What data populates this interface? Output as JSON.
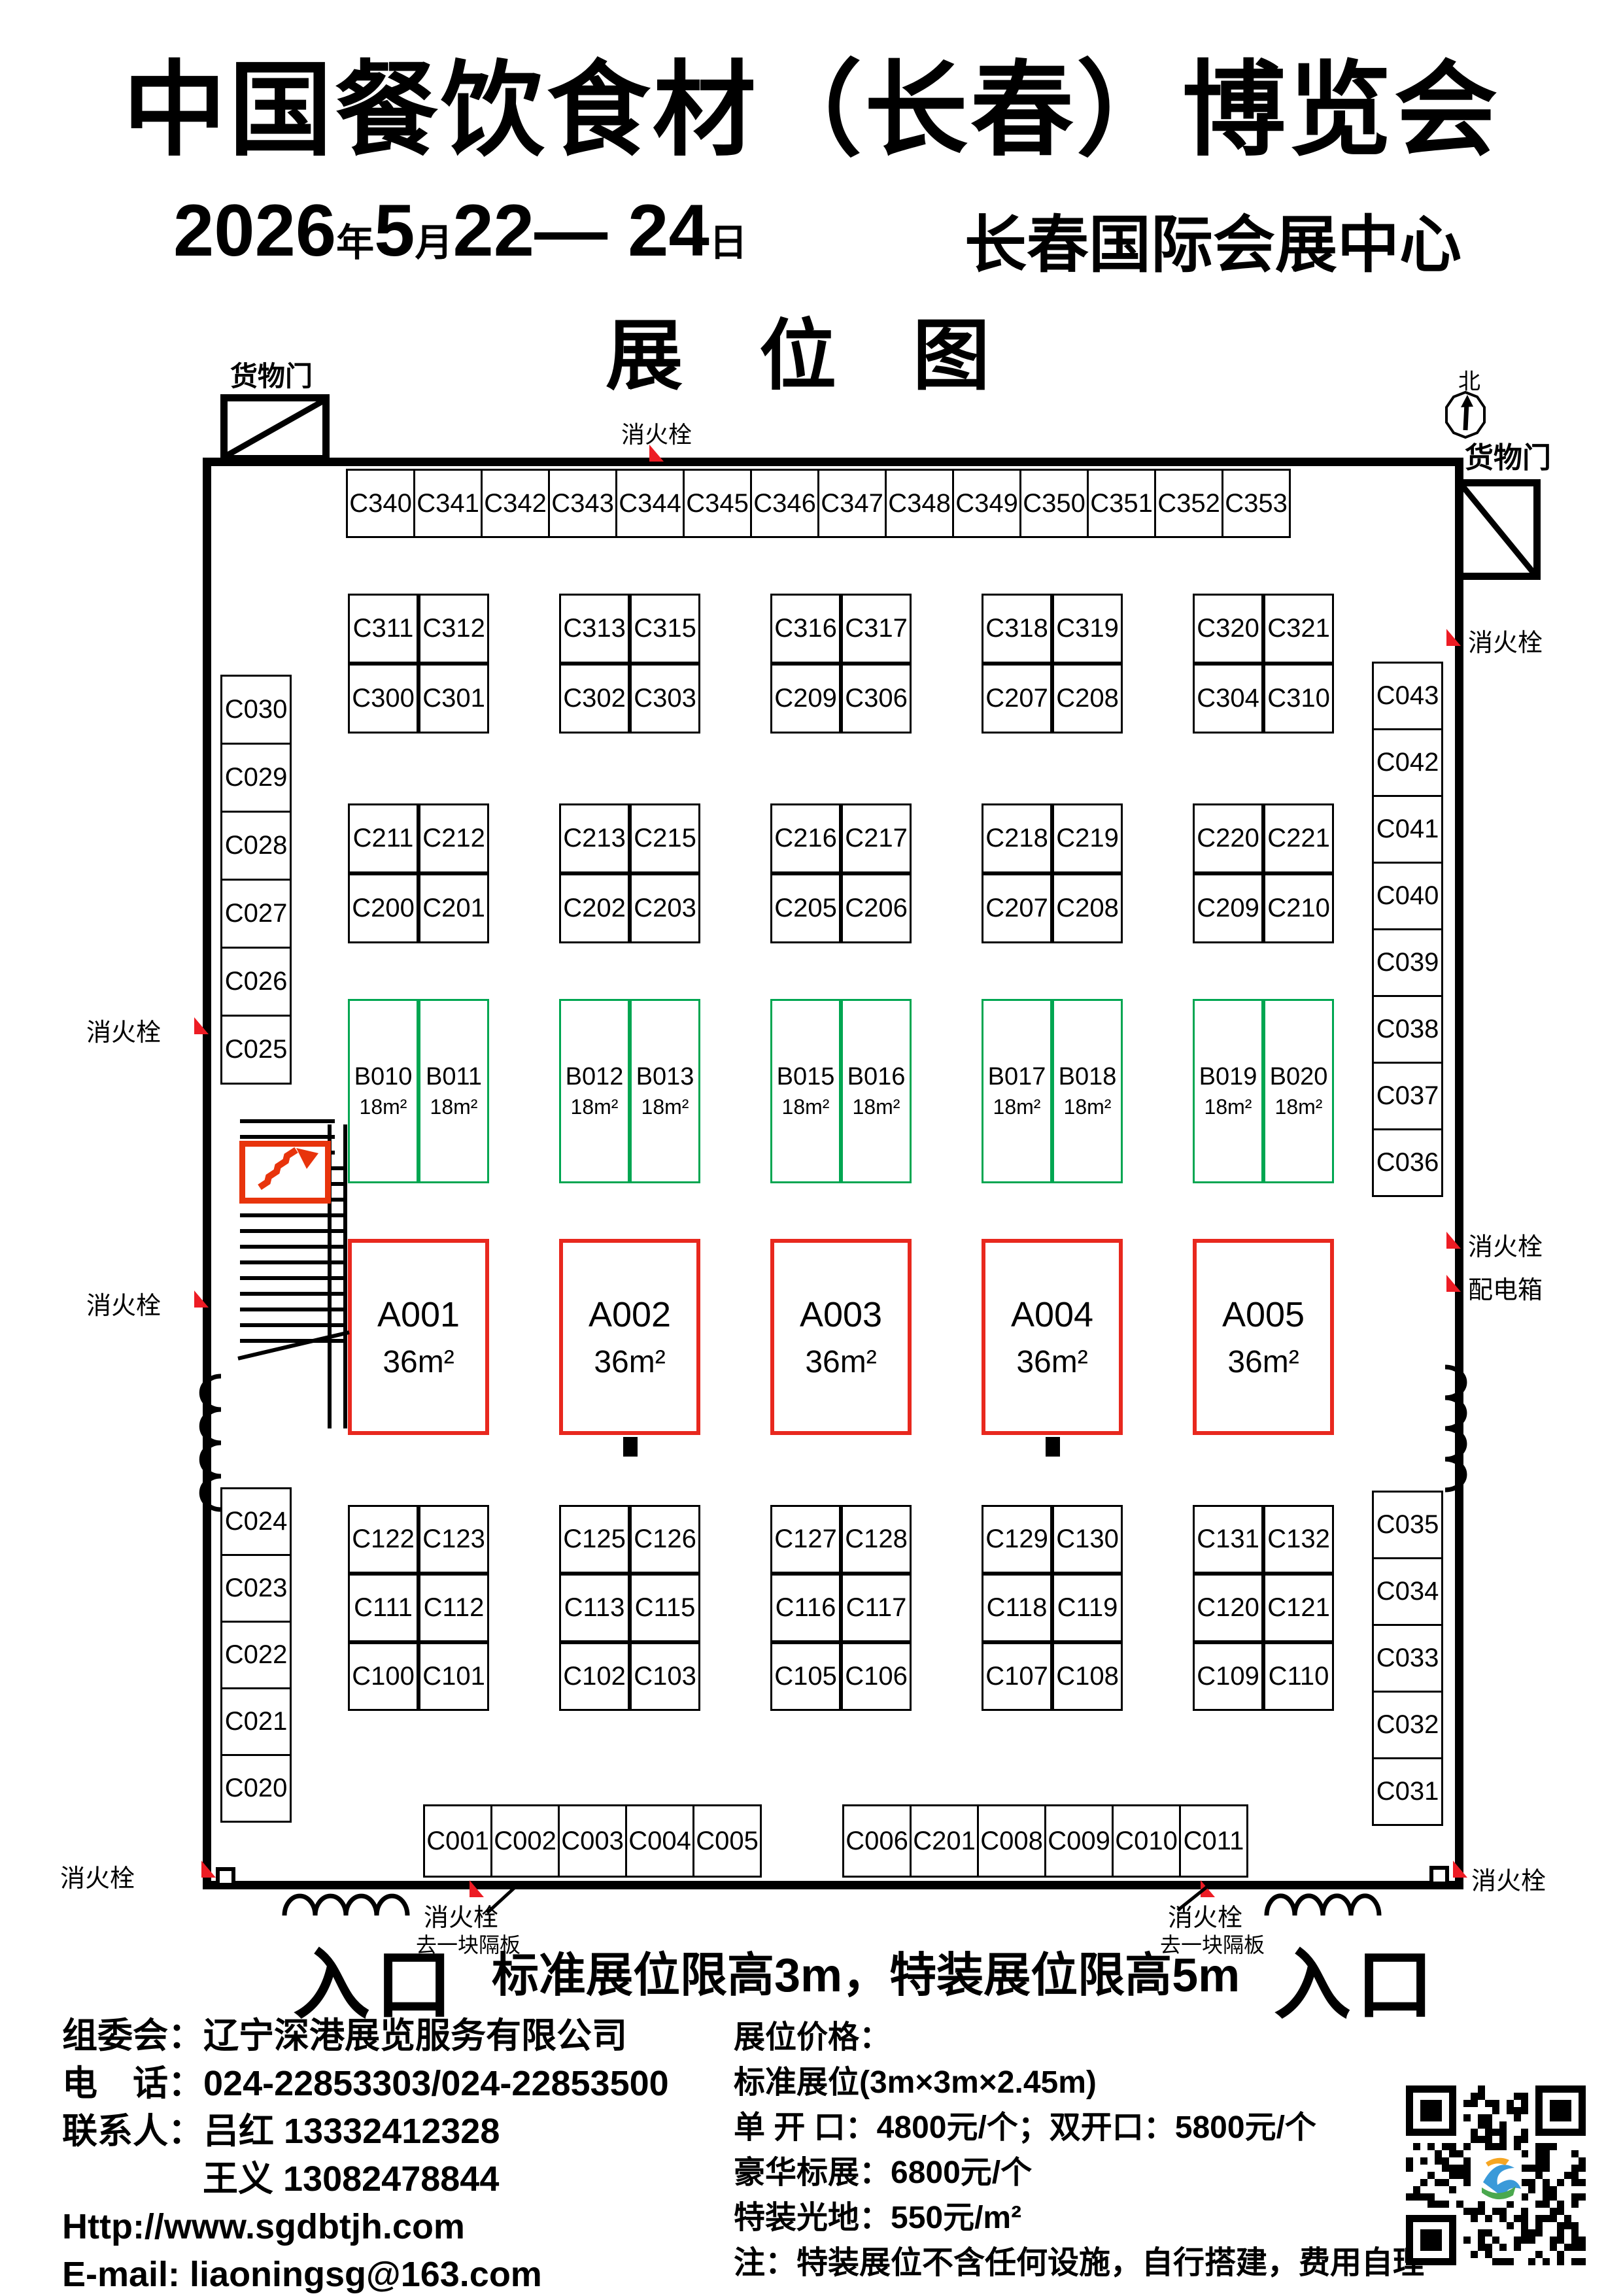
{
  "header": {
    "title": "中国餐饮食材（长春）博览会",
    "date": {
      "year": "2026",
      "year_suffix": "年",
      "month": "5",
      "month_suffix": "月",
      "days": "22— 24",
      "day_suffix": "日"
    },
    "venue": "长春国际会展中心",
    "map_title": "展 位 图"
  },
  "plan_labels": {
    "north": "北",
    "cargo_door": "货物门",
    "fire_hydrant": "消火栓",
    "power_box": "配电箱",
    "remove_panel": "去一块隔板",
    "entrance": "入口",
    "height_note": "标准展位限高3m，特装展位限高5m"
  },
  "booths": {
    "top_row": [
      "C340",
      "C341",
      "C342",
      "C343",
      "C344",
      "C345",
      "C346",
      "C347",
      "C348",
      "C349",
      "C350",
      "C351",
      "C352",
      "C353"
    ],
    "upper_blocks": [
      [
        "C311",
        "C312",
        "C300",
        "C301"
      ],
      [
        "C313",
        "C315",
        "C302",
        "C303"
      ],
      [
        "C316",
        "C317",
        "C209",
        "C306"
      ],
      [
        "C318",
        "C319",
        "C207",
        "C208"
      ],
      [
        "C320",
        "C321",
        "C304",
        "C310"
      ]
    ],
    "mid_blocks": [
      [
        "C211",
        "C212",
        "C200",
        "C201"
      ],
      [
        "C213",
        "C215",
        "C202",
        "C203"
      ],
      [
        "C216",
        "C217",
        "C205",
        "C206"
      ],
      [
        "C218",
        "C219",
        "C207",
        "C208"
      ],
      [
        "C220",
        "C221",
        "C209",
        "C210"
      ]
    ],
    "b_blocks": [
      [
        {
          "id": "B010",
          "area": "18m²"
        },
        {
          "id": "B011",
          "area": "18m²"
        }
      ],
      [
        {
          "id": "B012",
          "area": "18m²"
        },
        {
          "id": "B013",
          "area": "18m²"
        }
      ],
      [
        {
          "id": "B015",
          "area": "18m²"
        },
        {
          "id": "B016",
          "area": "18m²"
        }
      ],
      [
        {
          "id": "B017",
          "area": "18m²"
        },
        {
          "id": "B018",
          "area": "18m²"
        }
      ],
      [
        {
          "id": "B019",
          "area": "18m²"
        },
        {
          "id": "B020",
          "area": "18m²"
        }
      ]
    ],
    "a_row": [
      {
        "id": "A001",
        "area": "36m²"
      },
      {
        "id": "A002",
        "area": "36m²"
      },
      {
        "id": "A003",
        "area": "36m²"
      },
      {
        "id": "A004",
        "area": "36m²"
      },
      {
        "id": "A005",
        "area": "36m²"
      }
    ],
    "lower_blocks": [
      [
        "C122",
        "C123",
        "C111",
        "C112",
        "C100",
        "C101"
      ],
      [
        "C125",
        "C126",
        "C113",
        "C115",
        "C102",
        "C103"
      ],
      [
        "C127",
        "C128",
        "C116",
        "C117",
        "C105",
        "C106"
      ],
      [
        "C129",
        "C130",
        "C118",
        "C119",
        "C107",
        "C108"
      ],
      [
        "C131",
        "C132",
        "C120",
        "C121",
        "C109",
        "C110"
      ]
    ],
    "left_col_upper": [
      "C030",
      "C029",
      "C028",
      "C027",
      "C026",
      "C025"
    ],
    "left_col_lower": [
      "C024",
      "C023",
      "C022",
      "C021",
      "C020"
    ],
    "right_col_upper": [
      "C043",
      "C042",
      "C041",
      "C040",
      "C039",
      "C038",
      "C037",
      "C036"
    ],
    "right_col_lower": [
      "C035",
      "C034",
      "C033",
      "C032",
      "C031"
    ],
    "bottom_row_1": [
      "C001",
      "C002",
      "C003",
      "C004",
      "C005"
    ],
    "bottom_row_2": [
      "C006",
      "C201",
      "C008",
      "C009",
      "C010",
      "C011"
    ]
  },
  "footer": {
    "organizer_label": "组委会：",
    "organizer": "辽宁深港展览服务有限公司",
    "phone_label": "电　话：",
    "phone": "024-22853303/024-22853500",
    "contact_label": "联系人：",
    "contact1": "吕红 13332412328",
    "contact2": "王义 13082478844",
    "website": "Http://www.sgdbtjh.com",
    "email": "E-mail: liaoningsg@163.com",
    "prices": {
      "title": "展位价格：",
      "standard": "标准展位(3m×3m×2.45m)",
      "open": "单 开 口：4800元/个；双开口：5800元/个",
      "deluxe": "豪华标展：6800元/个",
      "raw_space": "特装光地：550元/m²",
      "note": "注：特装展位不含任何设施，自行搭建，费用自理"
    }
  },
  "colors": {
    "booth_green": "#00a651",
    "booth_red": "#e8281e",
    "marker_red": "#ed1c24"
  }
}
